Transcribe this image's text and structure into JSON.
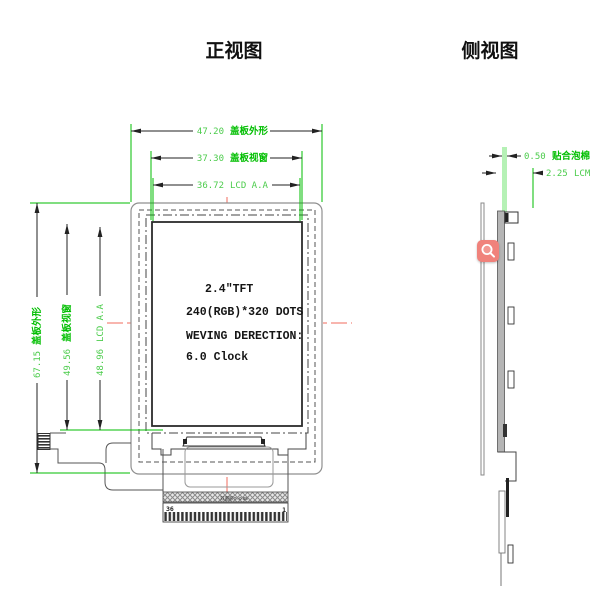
{
  "colors": {
    "dimension_green": "#00be00",
    "dimension_value_green": "#4ccc4c",
    "centerline_red": "#f26b5e",
    "zoom_button_salmon": "#F0827B",
    "outline_gray": "#8f8f8f",
    "drawing_black": "#2b2b2b"
  },
  "front_view": {
    "title": "正视图",
    "dims_top": [
      {
        "value": "47.20",
        "label": "盖板外形"
      },
      {
        "value": "37.30",
        "label": "盖板视窗"
      },
      {
        "value": "36.72",
        "label": "LCD A.A"
      }
    ],
    "dims_left": [
      {
        "value": "67.15",
        "label": "盖板外形"
      },
      {
        "value": "49.56",
        "label": "盖板视窗"
      },
      {
        "value": "48.96",
        "label": "LCD A.A"
      }
    ],
    "panel_text": {
      "line1": "2.4\"TFT",
      "line2": "240(RGB)*320 DOTS",
      "line3": "WEVING DERECTION:",
      "line4": "6.0 Clock"
    },
    "fpc": {
      "pin_first": "36",
      "pin_last": "1",
      "tape_label": "双面胶T=0.05"
    }
  },
  "side_view": {
    "title": "侧视图",
    "dims": [
      {
        "value": "0.50",
        "label": "贴合泡棉"
      },
      {
        "value": "2.25",
        "label": "LCM"
      }
    ]
  }
}
